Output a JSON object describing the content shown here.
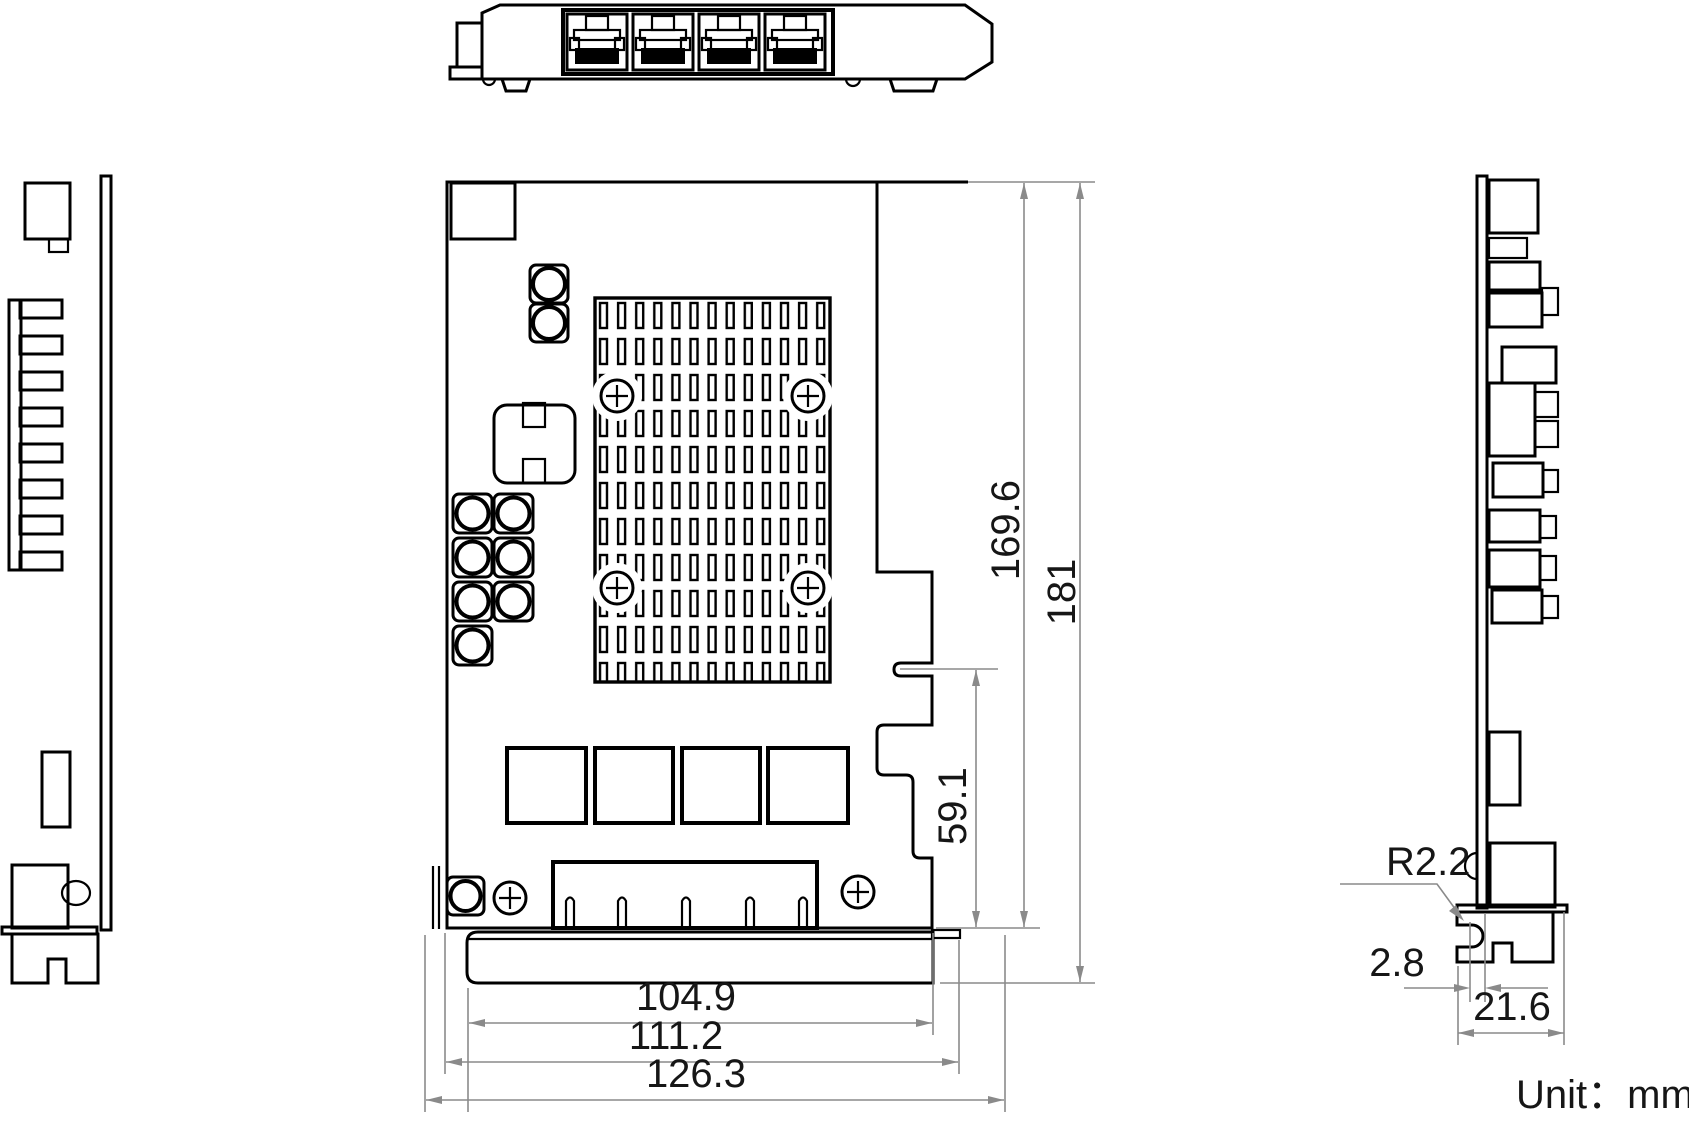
{
  "drawing": {
    "kind": "mechanical-dimension-drawing",
    "views": {
      "top_view": "bracket-edge-with-4-rj45-ports",
      "left_view": "card-left-profile",
      "front_view": "card-pcb-front",
      "right_view": "card-right-profile"
    },
    "dims": {
      "v169_6": "169.6",
      "v181": "181",
      "v59_1": "59.1",
      "v104_9": "104.9",
      "v111_2": "111.2",
      "v126_3": "126.3",
      "r2_2": "R2.2",
      "v2_8": "2.8",
      "v21_6": "21.6"
    },
    "note": {
      "unit_label": "Unit：mm"
    },
    "colors": {
      "part_line": "#000000",
      "dimension_line": "#8a8a8a",
      "text": "#161616",
      "background": "#ffffff"
    }
  }
}
